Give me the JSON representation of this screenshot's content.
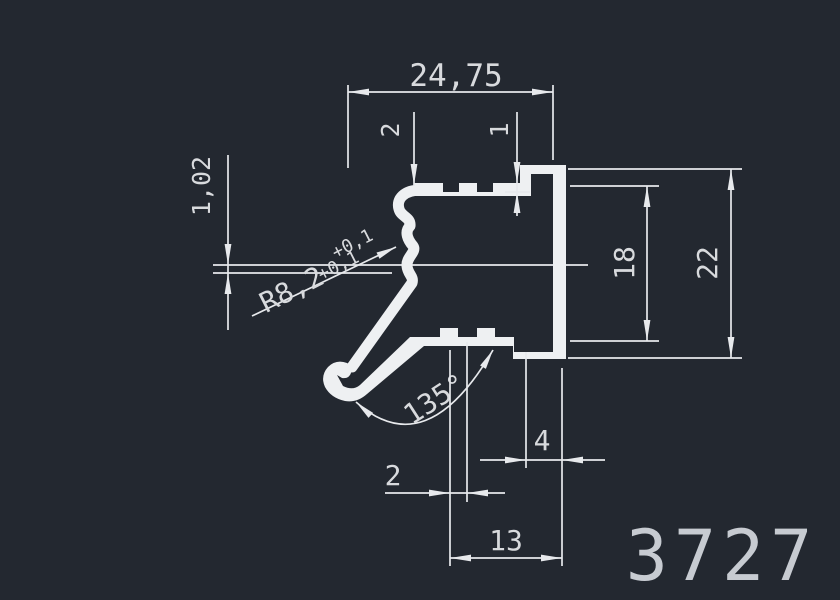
{
  "drawing": {
    "part_number": "3727",
    "type_label": "extrusion-profile-cross-section"
  },
  "colors": {
    "background": "#232830",
    "line": "#e7e9ec",
    "profile": "#eef0f2",
    "text": "#d8dadd",
    "partnum": "#c7cbd1"
  },
  "dimensions": {
    "width_top": "24,75",
    "top_wall_thickness": "2",
    "top_lip": "1",
    "left_gap": "1,02",
    "radius": "R8,2",
    "radius_tol_upper": "+0,1",
    "radius_tol_lower": "+0,1",
    "angle": "135°",
    "bottom_offset": "4",
    "bottom_tooth": "2",
    "bottom_width": "13",
    "height_inner": "18",
    "height_outer": "22"
  }
}
